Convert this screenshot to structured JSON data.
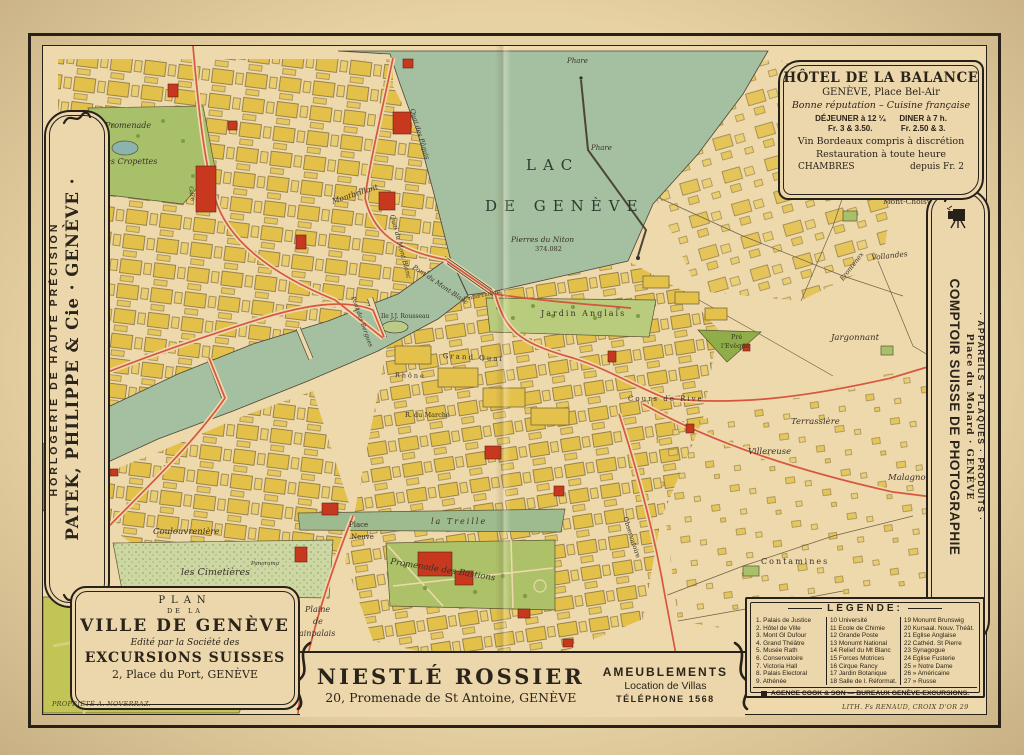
{
  "ads": {
    "patek": {
      "line1": "HORLOGERIE DE HAUTE PRÉCISION",
      "line2": "PATEK, PHILIPPE & Cie · GENÈVE ·"
    },
    "comptoir": {
      "title": "COMPTOIR SUISSE DE PHOTOGRAPHIE",
      "line2": "Place du Molard · GENÈVE",
      "line3": "· APPAREILS · PLAQUES · PRODUITS ·"
    },
    "hotel": {
      "title": "HÔTEL DE LA BALANCE",
      "subtitle": "GENÈVE, Place Bel-Air",
      "tagline": "Bonne réputation – Cuisine française",
      "dejeuner": "DÉJEUNER à 12 ¼",
      "dejeuner_price": "Fr. 3 & 3.50.",
      "diner": "DINER à 7 h.",
      "diner_price": "Fr. 2.50 & 3.",
      "line_wine": "Vin Bordeaux compris à discrétion",
      "line_rest": "Restauration à toute heure",
      "chambres": "CHAMBRES",
      "chambres_price": "depuis Fr. 2"
    },
    "plan": {
      "line1": "PLAN",
      "line2": "DE LA",
      "line3": "VILLE DE GENÈVE",
      "line4": "Edité par la Société des",
      "line5": "EXCURSIONS SUISSES",
      "line6": "2, Place du Port, GENÈVE"
    },
    "niestle": {
      "title": "NIESTLÉ ROSSIER",
      "address": "20, Promenade de St Antoine, GENÈVE",
      "right1": "AMEUBLEMENTS",
      "right2": "Location de Villas",
      "right3": "TÉLÉPHONE 1568"
    }
  },
  "legend": {
    "title": "LÉGENDE:",
    "col1": [
      "1. Palais de Justice",
      "2. Hôtel de Ville",
      "3. Mont Gl Dufour",
      "4. Grand Théâtre",
      "5. Musée Rath",
      "6. Conservatoire",
      "7. Victoria Hall",
      "8. Palais Electoral",
      "9. Athénée"
    ],
    "col2": [
      "10 Université",
      "11 Ecole de Chimie",
      "12 Grande Poste",
      "13 Monumt National",
      "14 Relief du Mt Blanc",
      "15 Forces Motrices",
      "16 Cirque Rancy",
      "17 Jardin Botanique",
      "18 Salle de l. Réformat."
    ],
    "col3": [
      "19 Monumt Brunswig",
      "20 Kursaal. Nouv. Théât.",
      "21 Eglise Anglaise",
      "22 Cathéd. St Pierre",
      "23 Synagogue",
      "24 Eglise Fusterie",
      "25 » Notre Dame",
      "26 » Américaine",
      "27 » Russe"
    ],
    "footer": "AGENCE COOK & SON — BUREAUX GENÈVE-EXCURSIONS."
  },
  "credits": {
    "left": "PROPRIÉTÉ A. NOVERRAZ.",
    "right": "LITH. Fs RENAUD, CROIX D'OR 29"
  },
  "map": {
    "labels": [
      "Phare",
      "LAC",
      "DE GENÈVE",
      "Phare",
      "Pierres du Niton",
      "374.082",
      "Promenade",
      "des Cropettes",
      "Montbrillant",
      "Quai des Pâquis",
      "Quai du Mont Blanc",
      "Pont du Mont-Blanc",
      "Pont des Bergues",
      "Ile J.J. Rousseau",
      "Embarcadère",
      "Jardin Anglais",
      "Grand Quai",
      "Rhône",
      "R. du Marché",
      "Cours de Rive",
      "Terrassière",
      "Villereuse",
      "Malagnou",
      "Jargonnant",
      "Pré",
      "l'Evêque",
      "Mont-Choisy",
      "Vollandes",
      "Frontenex",
      "Coulouvrenière",
      "les Cimetières",
      "la Treille",
      "Promenade des Bastions",
      "Place",
      "Neuve",
      "Plaine",
      "de",
      "Plainpalais",
      "Gare",
      "Observatoire",
      "Contamines",
      "Panorama"
    ]
  },
  "icons": {
    "camera": "bellows-camera",
    "legend_marker": "black-square",
    "ornament": "art-nouveau-curl"
  },
  "colors": {
    "paper": "#eed9ad",
    "ink": "#28211a",
    "lake": "#a4c0a0",
    "blocks_yellow": "#e3c049",
    "landmark_red": "#c8381f",
    "park_green": "#a9c06a",
    "tram_red": "#d5503a"
  }
}
